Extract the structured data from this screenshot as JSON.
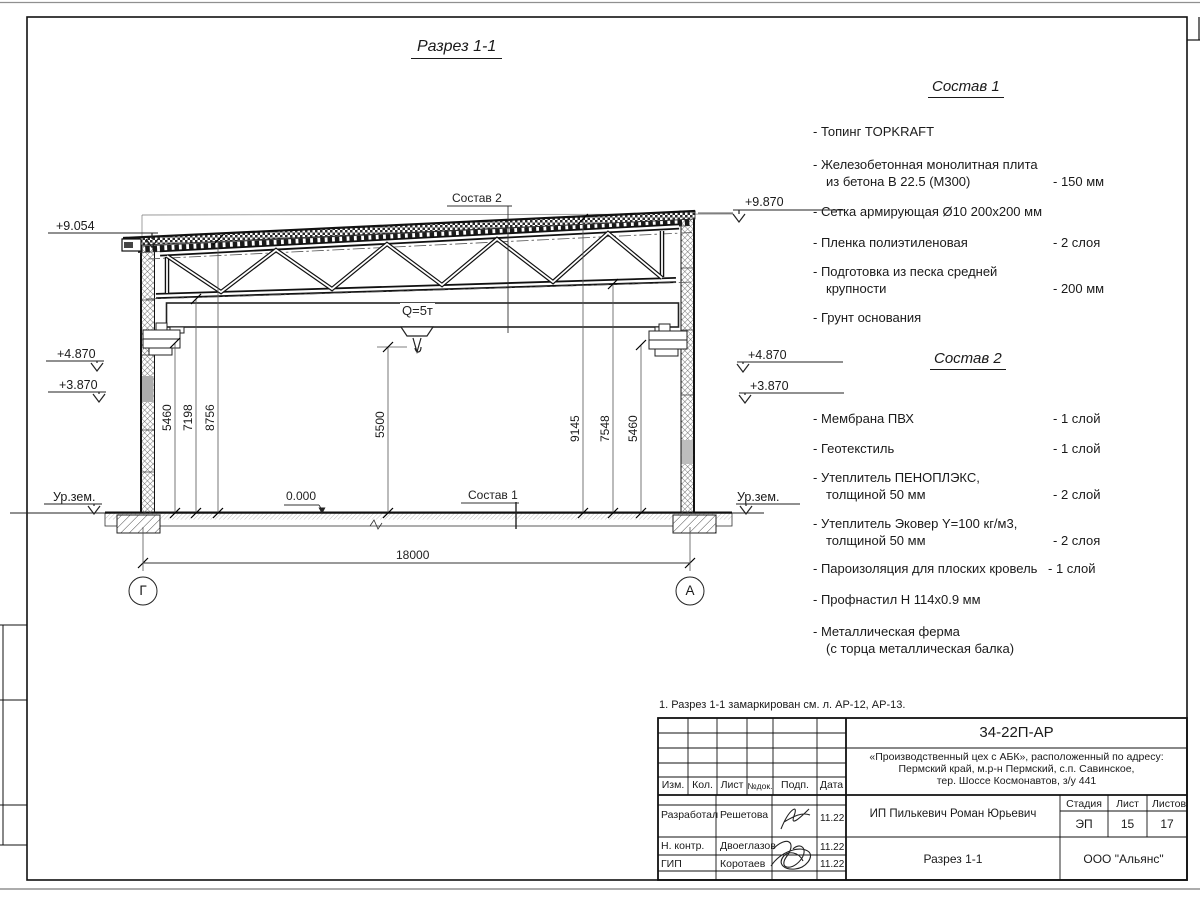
{
  "page": {
    "title": "Разрез 1-1",
    "note": "1. Разрез 1-1 замаркирован см. л. АР-12, АР-13."
  },
  "colors": {
    "ink": "#1a1a1a",
    "dim_line": "#444444"
  },
  "drawing": {
    "section_ref_top": "Состав 2",
    "section_ref_floor": "Состав 1",
    "crane_capacity": "Q=5т",
    "zero_level": "0.000",
    "span_dim": "18000",
    "dims": {
      "left": [
        "5460",
        "7198",
        "8756"
      ],
      "center": "5500",
      "right": [
        "9145",
        "7548",
        "5460"
      ]
    },
    "elevations": {
      "left": [
        "+9.054",
        "+4.870",
        "+3.870",
        "Ур.зем."
      ],
      "right": [
        "+9.870",
        "+4.870",
        "+3.870",
        "Ур.зем."
      ]
    },
    "axes": {
      "left": "Г",
      "right": "А"
    }
  },
  "sostav1": {
    "heading": "Состав 1",
    "items": [
      {
        "l1": "- Топинг TOPKRAFT",
        "l2": "",
        "value": ""
      },
      {
        "l1": "- Железобетонная  монолитная плита",
        "l2": "из бетона В 22.5 (М300)",
        "value": "- 150 мм"
      },
      {
        "l1": "- Сетка армирующая Ø10 200х200 мм",
        "l2": "",
        "value": ""
      },
      {
        "l1": "- Пленка полиэтиленовая",
        "l2": "",
        "value": "-  2 слоя"
      },
      {
        "l1": "- Подготовка из песка средней",
        "l2": "крупности",
        "value": "- 200 мм"
      },
      {
        "l1": "- Грунт основания",
        "l2": "",
        "value": ""
      }
    ]
  },
  "sostav2": {
    "heading": "Состав 2",
    "items": [
      {
        "l1": "- Мембрана ПВХ",
        "l2": "",
        "value": "- 1 слой"
      },
      {
        "l1": "- Геотекстиль",
        "l2": "",
        "value": "- 1 слой"
      },
      {
        "l1": "- Утеплитель ПЕНОПЛЭКС,",
        "l2": "толщиной 50 мм",
        "value": "- 2 слой"
      },
      {
        "l1": "- Утеплитель Эковер Y=100 кг/м3,",
        "l2": "толщиной 50 мм",
        "value": "- 2 слоя"
      },
      {
        "l1": "- Пароизоляция для плоских кровель",
        "l2": "",
        "value": "- 1 слой"
      },
      {
        "l1": "- Профнастил Н 114х0.9 мм",
        "l2": "",
        "value": ""
      },
      {
        "l1": "- Металлическая ферма",
        "l2": "(с торца металлическая балка)",
        "value": ""
      }
    ]
  },
  "titleblock": {
    "doc_number": "34-22П-АР",
    "project_line1": "«Производственный цех с АБК», расположенный по адресу:",
    "project_line2": "Пермский край, м.р-н Пермский, с.п. Савинское,",
    "project_line3": "тер. Шоссе Космонавтов, з/у 441",
    "columns": [
      "Изм.",
      "Кол.",
      "Лист",
      "№док.",
      "Подп.",
      "Дата"
    ],
    "rows": [
      {
        "role": "Разработал",
        "name": "Решетова",
        "date": "11.22"
      },
      {
        "role": "Н. контр.",
        "name": "Двоеглазов",
        "date": "11.22"
      },
      {
        "role": "ГИП",
        "name": "Коротаев",
        "date": "11.22"
      }
    ],
    "client": "ИП Пилькевич Роман Юрьевич",
    "stage_label": "Стадия",
    "sheet_label": "Лист",
    "sheets_label": "Листов",
    "stage": "ЭП",
    "sheet": "15",
    "sheets": "17",
    "sheet_title": "Разрез 1-1",
    "company": "ООО \"Альянс\""
  }
}
